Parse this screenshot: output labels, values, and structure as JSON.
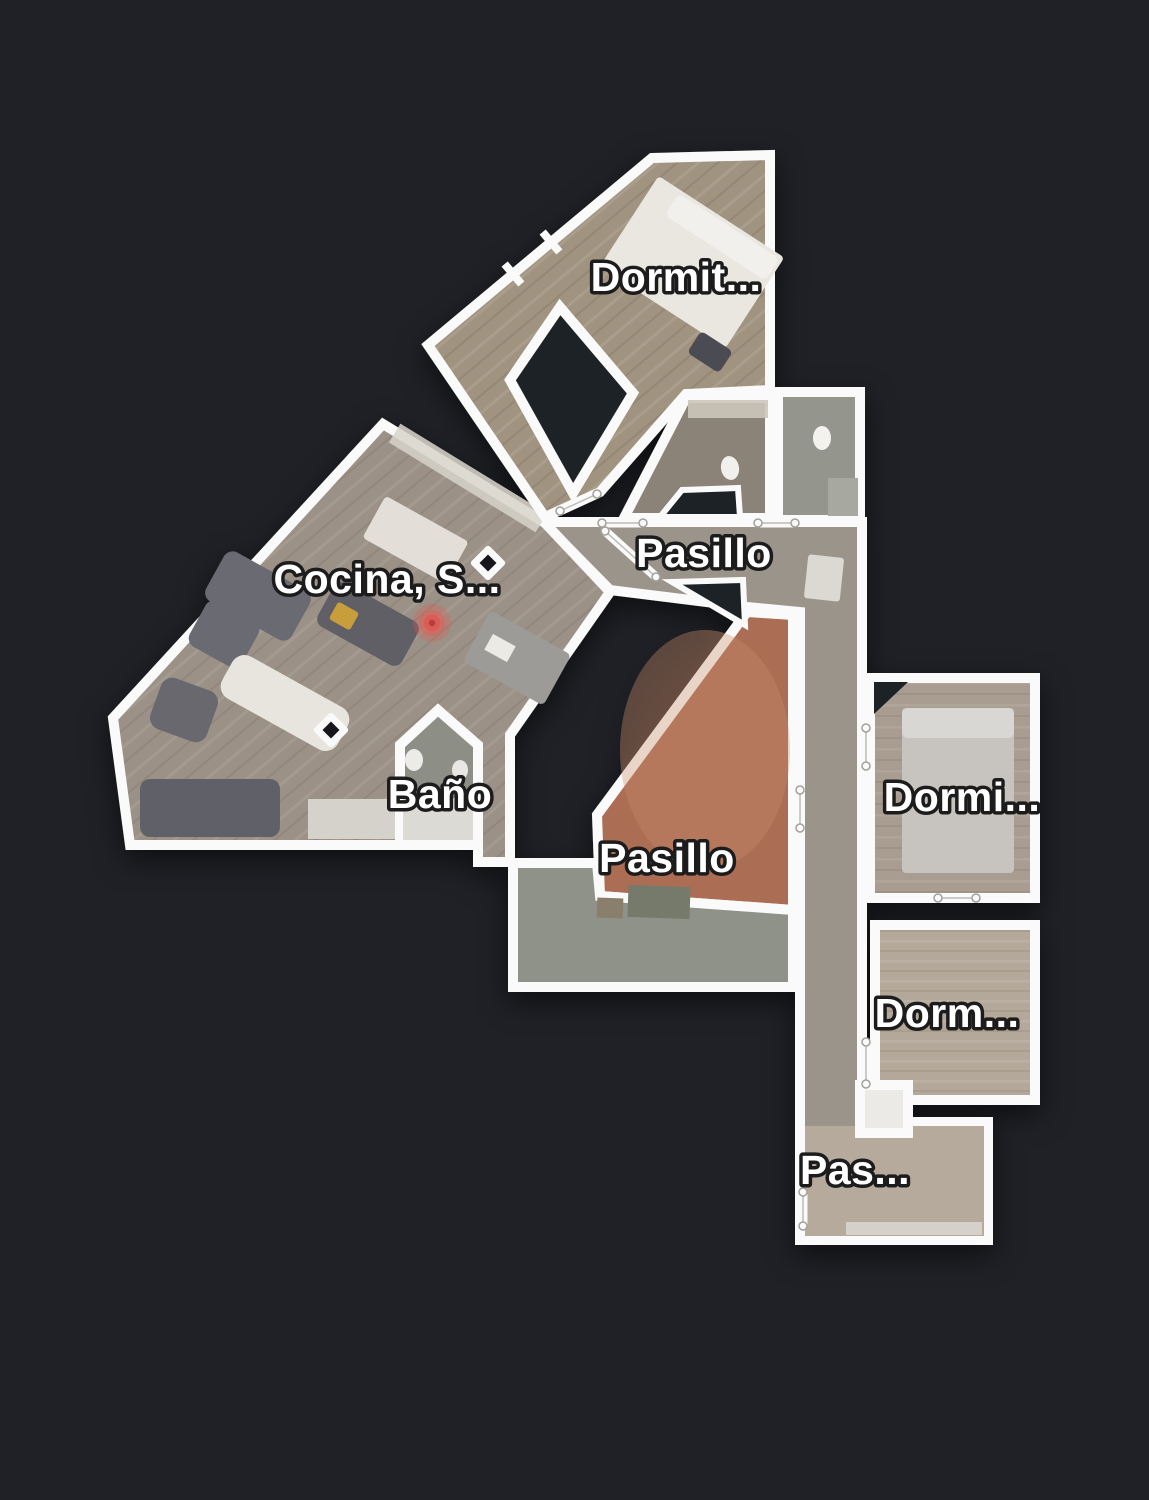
{
  "app": {
    "view": "floorplan-top-view",
    "background_color": "#1f2126",
    "wall_color": "#fafafa"
  },
  "floorplan": {
    "rooms": [
      {
        "id": "dormitorio-1",
        "label": "Dormit...",
        "label_x": 676,
        "label_y": 291
      },
      {
        "id": "pasillo-1",
        "label": "Pasillo",
        "label_x": 704,
        "label_y": 567
      },
      {
        "id": "cocina-salon",
        "label": "Cocina, S...",
        "label_x": 387,
        "label_y": 593
      },
      {
        "id": "bano",
        "label": "Baño",
        "label_x": 440,
        "label_y": 808
      },
      {
        "id": "pasillo-2",
        "label": "Pasillo",
        "label_x": 667,
        "label_y": 872
      },
      {
        "id": "dormitorio-2",
        "label": "Dormi...",
        "label_x": 962,
        "label_y": 811
      },
      {
        "id": "dormitorio-3",
        "label": "Dorm...",
        "label_x": 947,
        "label_y": 1027
      },
      {
        "id": "pasillo-3",
        "label": "Pas...",
        "label_x": 855,
        "label_y": 1184
      }
    ],
    "colors": {
      "bedroom_floor": "#a09380",
      "living_floor": "#9b9187",
      "hall_floor": "#9b948a",
      "patio_floor": "#ab6e54",
      "patio_highlight": "#c98b6b",
      "green_corridor_floor": "#8f9288",
      "bath_small_floor": "#8b8377",
      "bath_top_floor": "#94968d",
      "bano_floor": "#8d8e86",
      "bedroom2_floor": "#a29a8f",
      "bedroom3_floor": "#b1a697",
      "pas_floor": "#b5aa9b",
      "marker_red": "#dd5a54"
    },
    "position_marker": {
      "x": 432,
      "y": 623
    },
    "view_markers": [
      {
        "x": 488,
        "y": 563
      },
      {
        "x": 331,
        "y": 730
      }
    ]
  }
}
